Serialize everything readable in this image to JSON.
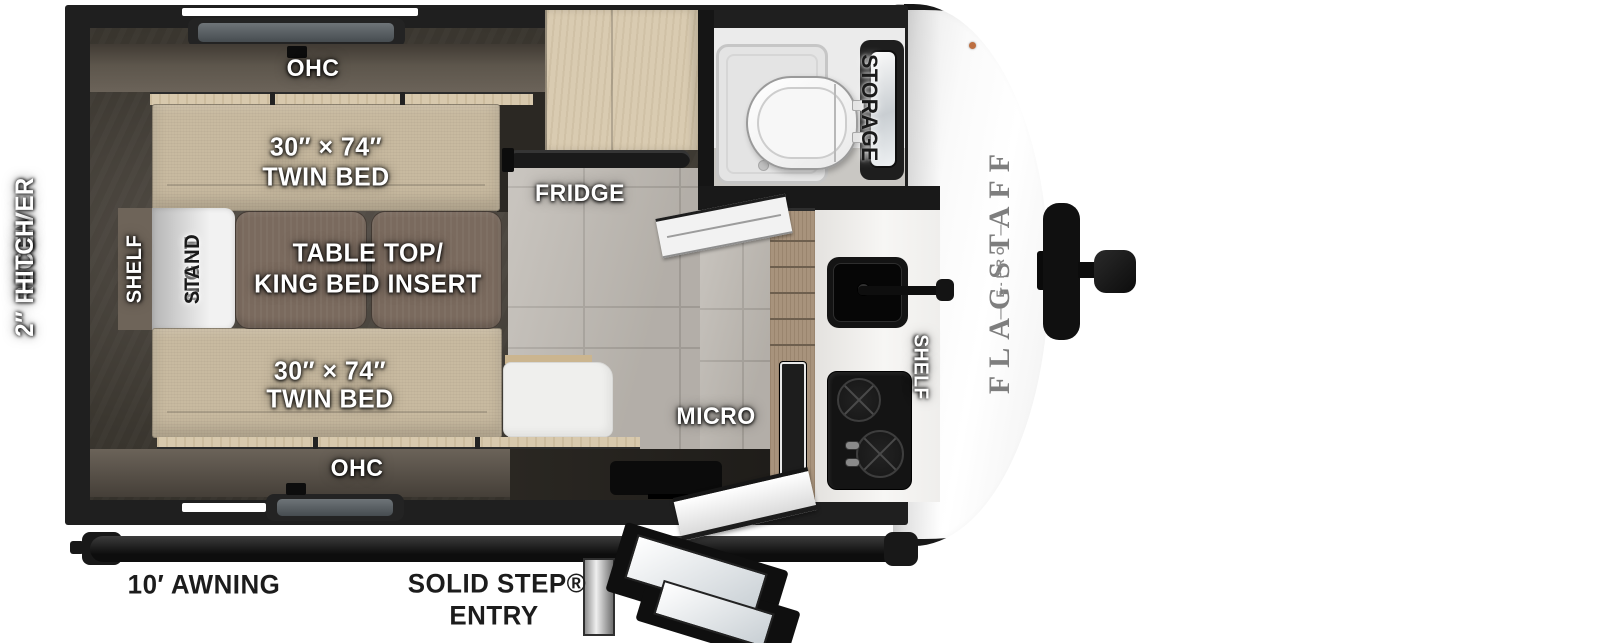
{
  "page": {
    "title": "Flagstaff E-Pro travel trailer floor plan"
  },
  "colors": {
    "wall": "#1f1f1f",
    "mattress": "#c8baa0",
    "table_wood": "#7a6a5e",
    "light_wood": "#d9cbb1",
    "cabinet_wood": "#a8937c",
    "floor_tile": "#beb9b2",
    "counter": "#f0efed",
    "cap_white": "#f6f6f6",
    "label_white": "#ffffff",
    "label_black": "#1c1c1c"
  },
  "exterior": {
    "hitch_line1": "2″ RECEIVER",
    "hitch_line2": "HITCH",
    "awning": "10′ AWNING",
    "entry_line1": "SOLID STEP®",
    "entry_line2": "ENTRY",
    "brand": "FLAGSTAFF",
    "brand_model": "— E-PRO —"
  },
  "bedroom": {
    "ohc_top": "OHC",
    "ohc_bottom": "OHC",
    "bed_top_size": "30″ × 74″",
    "bed_top_name": "TWIN BED",
    "bed_bottom_size": "30″ × 74″",
    "bed_bottom_name": "TWIN BED",
    "shelf": "SHELF",
    "night_line1": "NIGHT",
    "night_line2": "STAND",
    "table_line1": "TABLE TOP/",
    "table_line2": "KING BED INSERT"
  },
  "kitchen": {
    "fridge": "FRIDGE",
    "micro": "MICRO",
    "shelf": "SHELF"
  },
  "bathroom": {
    "storage": "STORAGE"
  }
}
